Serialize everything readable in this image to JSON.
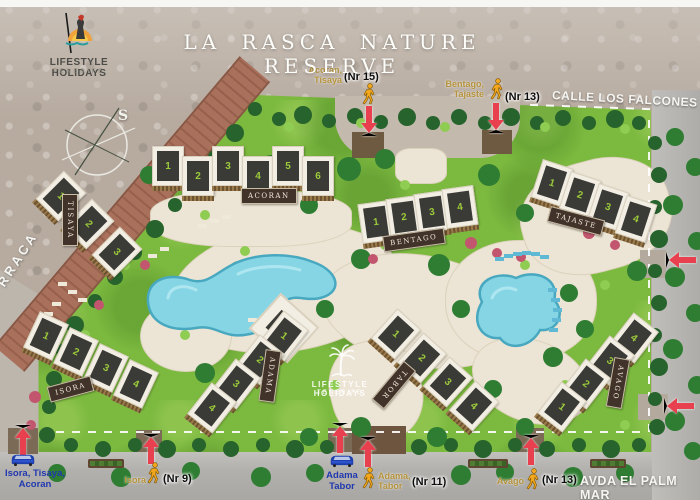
{
  "header": {
    "title": "LA RASCA NATURE RESERVE",
    "logo_line1": "LIFESTYLE HOLIDAYS",
    "logo_line2": "TENERIFE"
  },
  "watermark": {
    "line1": "LIFESTYLE HOLIDAYS",
    "line2": "TENERIFE"
  },
  "compass": {
    "label": "S"
  },
  "streets": {
    "top": "CALLE LOS FALCONES",
    "bottom": "AVDA EL PALM MAR",
    "left_partial": "RRACA"
  },
  "buildings": [
    {
      "id": "tisaya",
      "name": "TISAYA",
      "units": [
        "1",
        "2",
        "3"
      ]
    },
    {
      "id": "acoran",
      "name": "ACORAN",
      "units": [
        "1",
        "2",
        "3",
        "4",
        "5",
        "6"
      ]
    },
    {
      "id": "bentago",
      "name": "BENTAGO",
      "units": [
        "1",
        "2",
        "3",
        "4"
      ]
    },
    {
      "id": "tajaste",
      "name": "TAJASTE",
      "units": [
        "1",
        "2",
        "3",
        "4"
      ]
    },
    {
      "id": "isora",
      "name": "ISORA",
      "units": [
        "1",
        "2",
        "3",
        "4"
      ]
    },
    {
      "id": "adama",
      "name": "ADAMA",
      "units": [
        "1",
        "2",
        "3",
        "4"
      ]
    },
    {
      "id": "tabor",
      "name": "TABOR",
      "units": [
        "1",
        "2",
        "3",
        "4"
      ]
    },
    {
      "id": "avago",
      "name": "AVAGO",
      "units": [
        "4",
        "3",
        "2",
        "1"
      ]
    }
  ],
  "entrances": {
    "top": [
      {
        "label_line1": "Acoran,",
        "label_line2": "Tisaya",
        "nr": "(Nr 15)",
        "mode": "pedestrian"
      },
      {
        "label_line1": "Bentago,",
        "label_line2": "Tajaste",
        "nr": "(Nr 13)",
        "mode": "pedestrian"
      }
    ],
    "bottom": [
      {
        "label_line1": "Isora, Tisaya,",
        "label_line2": "Acoran",
        "mode": "car"
      },
      {
        "label": "Isora",
        "nr": "(Nr 9)",
        "mode": "pedestrian"
      },
      {
        "label_line1": "Adama",
        "label_line2": "Tabor",
        "mode": "car"
      },
      {
        "label_line1": "Adama,",
        "label_line2": "Tabor",
        "nr": "(Nr 11)",
        "mode": "pedestrian"
      },
      {
        "label": "Avago",
        "nr": "(Nr 13)",
        "mode": "pedestrian"
      }
    ]
  },
  "colors": {
    "arrow_red": "#e8404e",
    "pedestrian_yellow": "#f2a71d",
    "car_blue": "#1e3fae",
    "pool_blue": "#85d5e5",
    "grass_green": "#7cb93f",
    "gold_label": "#b5933c",
    "blue_label": "#2038b0"
  }
}
